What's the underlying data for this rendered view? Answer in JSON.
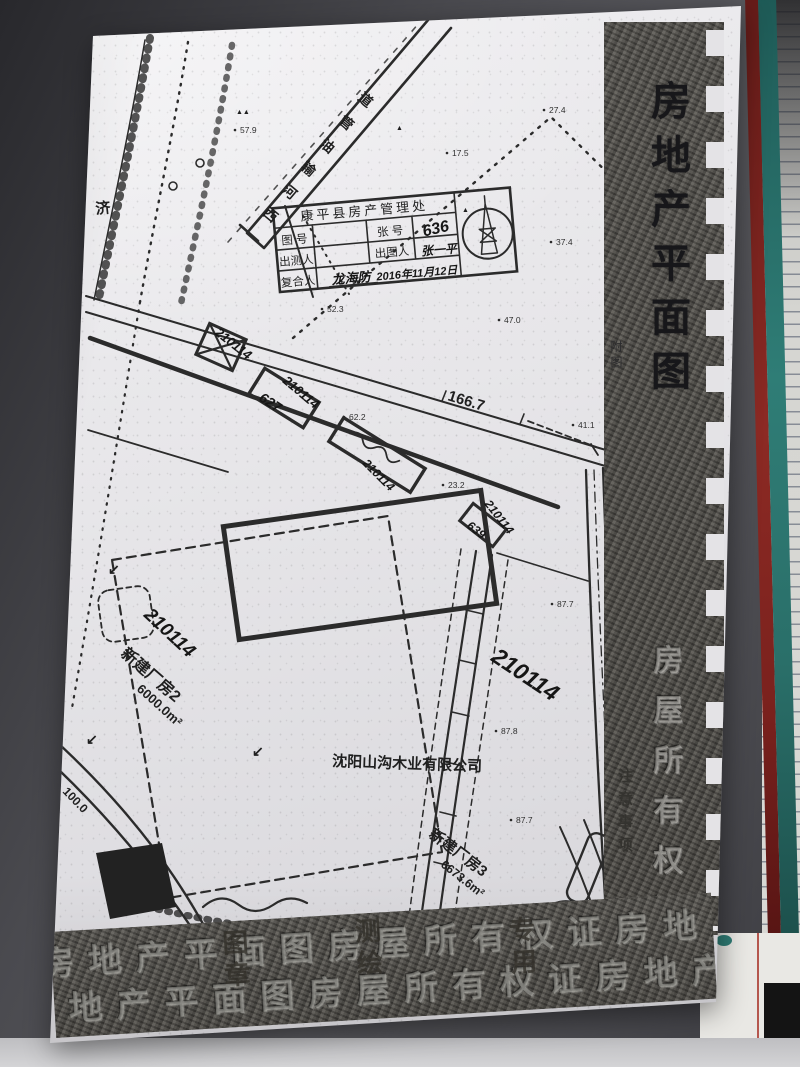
{
  "photo": {
    "background": "#4a4a4f",
    "desk_surface": "#d4d4d6",
    "notebook_red_edge": "#8c2a24",
    "notebook_teal_edge": "#2f7d76",
    "paper_color": "#e7e6e9"
  },
  "paper_doc": {
    "side_band": {
      "title": "房地产平面图",
      "corner_note": "附图",
      "lower_emboss": "房屋所有权证",
      "lower_dark_note": "注意事项"
    },
    "bottom_band": {
      "repeat_text": "房地产平面图房屋所有权证房地产平面图",
      "overlay_marks": [
        "图章",
        "测绘",
        "专用"
      ]
    }
  },
  "stamp": {
    "title": "康平县房产管理处",
    "row1_label_left": "图 号",
    "row1_value_left": "",
    "row1_label_right": "张 号",
    "row1_value_right": "636",
    "row2_label_left": "出测人",
    "row2_value_left": "",
    "row2_label_right": "出图人",
    "row2_value_right": "张一平",
    "row3_label": "复合人",
    "row3_value": "龙海防",
    "date": "2016年11月12日"
  },
  "map": {
    "company": "沈阳山沟木业有限公司",
    "parcel_no": "210114",
    "buildings": [
      {
        "name": "新建厂房2",
        "area": "6000.0m²"
      },
      {
        "name": "新建厂房3",
        "area": "6673.6m²"
      }
    ],
    "pipeline_label": "西河输油管道",
    "rail_label": "济",
    "boundary_length": "166.7",
    "road_label": "100.0",
    "plot_numbers": [
      "627",
      "639"
    ],
    "labels": [
      {
        "t": "济",
        "x": 96,
        "y": 214,
        "r": -6,
        "s": 15,
        "c": "p"
      },
      {
        "t": "西",
        "x": 262,
        "y": 214,
        "r": 40,
        "s": 14,
        "c": "p"
      },
      {
        "t": "河",
        "x": 281,
        "y": 191,
        "r": 40,
        "s": 14,
        "c": "p"
      },
      {
        "t": "输",
        "x": 300,
        "y": 168,
        "r": 40,
        "s": 14,
        "c": "p"
      },
      {
        "t": "油",
        "x": 319,
        "y": 145,
        "r": 40,
        "s": 14,
        "c": "p"
      },
      {
        "t": "管",
        "x": 338,
        "y": 122,
        "r": 40,
        "s": 14,
        "c": "p"
      },
      {
        "t": "道",
        "x": 357,
        "y": 99,
        "r": 40,
        "s": 14,
        "c": "p"
      },
      {
        "t": "166.7",
        "x": 447,
        "y": 400,
        "r": 17,
        "s": 15,
        "c": "p"
      },
      {
        "t": "100.0",
        "x": 62,
        "y": 792,
        "r": 46,
        "s": 12,
        "c": "p"
      },
      {
        "t": "新建厂房2",
        "x": 120,
        "y": 655,
        "r": 41,
        "s": 16,
        "c": "p"
      },
      {
        "t": "6000.0m²",
        "x": 136,
        "y": 690,
        "r": 42,
        "s": 13,
        "c": "p"
      },
      {
        "t": "新建厂房3",
        "x": 428,
        "y": 836,
        "r": 37,
        "s": 15,
        "c": "p"
      },
      {
        "t": "6673.6m²",
        "x": 440,
        "y": 866,
        "r": 38,
        "s": 12,
        "c": "p"
      },
      {
        "t": "沈阳山沟木业有限公司",
        "x": 332,
        "y": 766,
        "r": 2,
        "s": 15,
        "c": "p"
      },
      {
        "t": "210114",
        "x": 214,
        "y": 334,
        "r": 38,
        "s": 13,
        "c": "hw"
      },
      {
        "t": "210114",
        "x": 282,
        "y": 382,
        "r": 40,
        "s": 13,
        "c": "hw"
      },
      {
        "t": "627",
        "x": 258,
        "y": 400,
        "r": 33,
        "s": 14,
        "c": "hw"
      },
      {
        "t": "210114",
        "x": 362,
        "y": 464,
        "r": 45,
        "s": 12,
        "c": "hw"
      },
      {
        "t": "639",
        "x": 466,
        "y": 527,
        "r": 38,
        "s": 12,
        "c": "hw"
      },
      {
        "t": "210114",
        "x": 484,
        "y": 504,
        "r": 52,
        "s": 12,
        "c": "hw"
      },
      {
        "t": "210114",
        "x": 143,
        "y": 616,
        "r": 43,
        "s": 19,
        "c": "hw"
      },
      {
        "t": "210114",
        "x": 490,
        "y": 660,
        "r": 34,
        "s": 23,
        "c": "hw"
      },
      {
        "t": "↙",
        "x": 108,
        "y": 574,
        "r": 0,
        "s": 14,
        "c": "p"
      },
      {
        "t": "↙",
        "x": 86,
        "y": 744,
        "r": 0,
        "s": 14,
        "c": "p"
      },
      {
        "t": "↙",
        "x": 252,
        "y": 756,
        "r": 0,
        "s": 14,
        "c": "p"
      },
      {
        "t": "▲▲",
        "x": 236,
        "y": 114,
        "r": 0,
        "s": 7,
        "c": "p"
      },
      {
        "t": "▲",
        "x": 396,
        "y": 130,
        "r": 0,
        "s": 7,
        "c": "p"
      },
      {
        "t": "▲",
        "x": 610,
        "y": 143,
        "r": 0,
        "s": 7,
        "c": "p"
      },
      {
        "t": "▲",
        "x": 462,
        "y": 212,
        "r": 0,
        "s": 7,
        "c": "p"
      }
    ],
    "elevations": [
      {
        "v": "57.9",
        "x": 240,
        "y": 133
      },
      {
        "v": "17.5",
        "x": 452,
        "y": 156
      },
      {
        "v": "27.4",
        "x": 549,
        "y": 113
      },
      {
        "v": "37.4",
        "x": 556,
        "y": 245
      },
      {
        "v": "47.0",
        "x": 504,
        "y": 323
      },
      {
        "v": "52.3",
        "x": 327,
        "y": 312
      },
      {
        "v": "62.2",
        "x": 349,
        "y": 420
      },
      {
        "v": "23.2",
        "x": 448,
        "y": 488
      },
      {
        "v": "41.1",
        "x": 578,
        "y": 428
      },
      {
        "v": "87.7",
        "x": 557,
        "y": 607
      },
      {
        "v": "87.8",
        "x": 501,
        "y": 734
      },
      {
        "v": "87.7",
        "x": 516,
        "y": 823
      }
    ]
  }
}
